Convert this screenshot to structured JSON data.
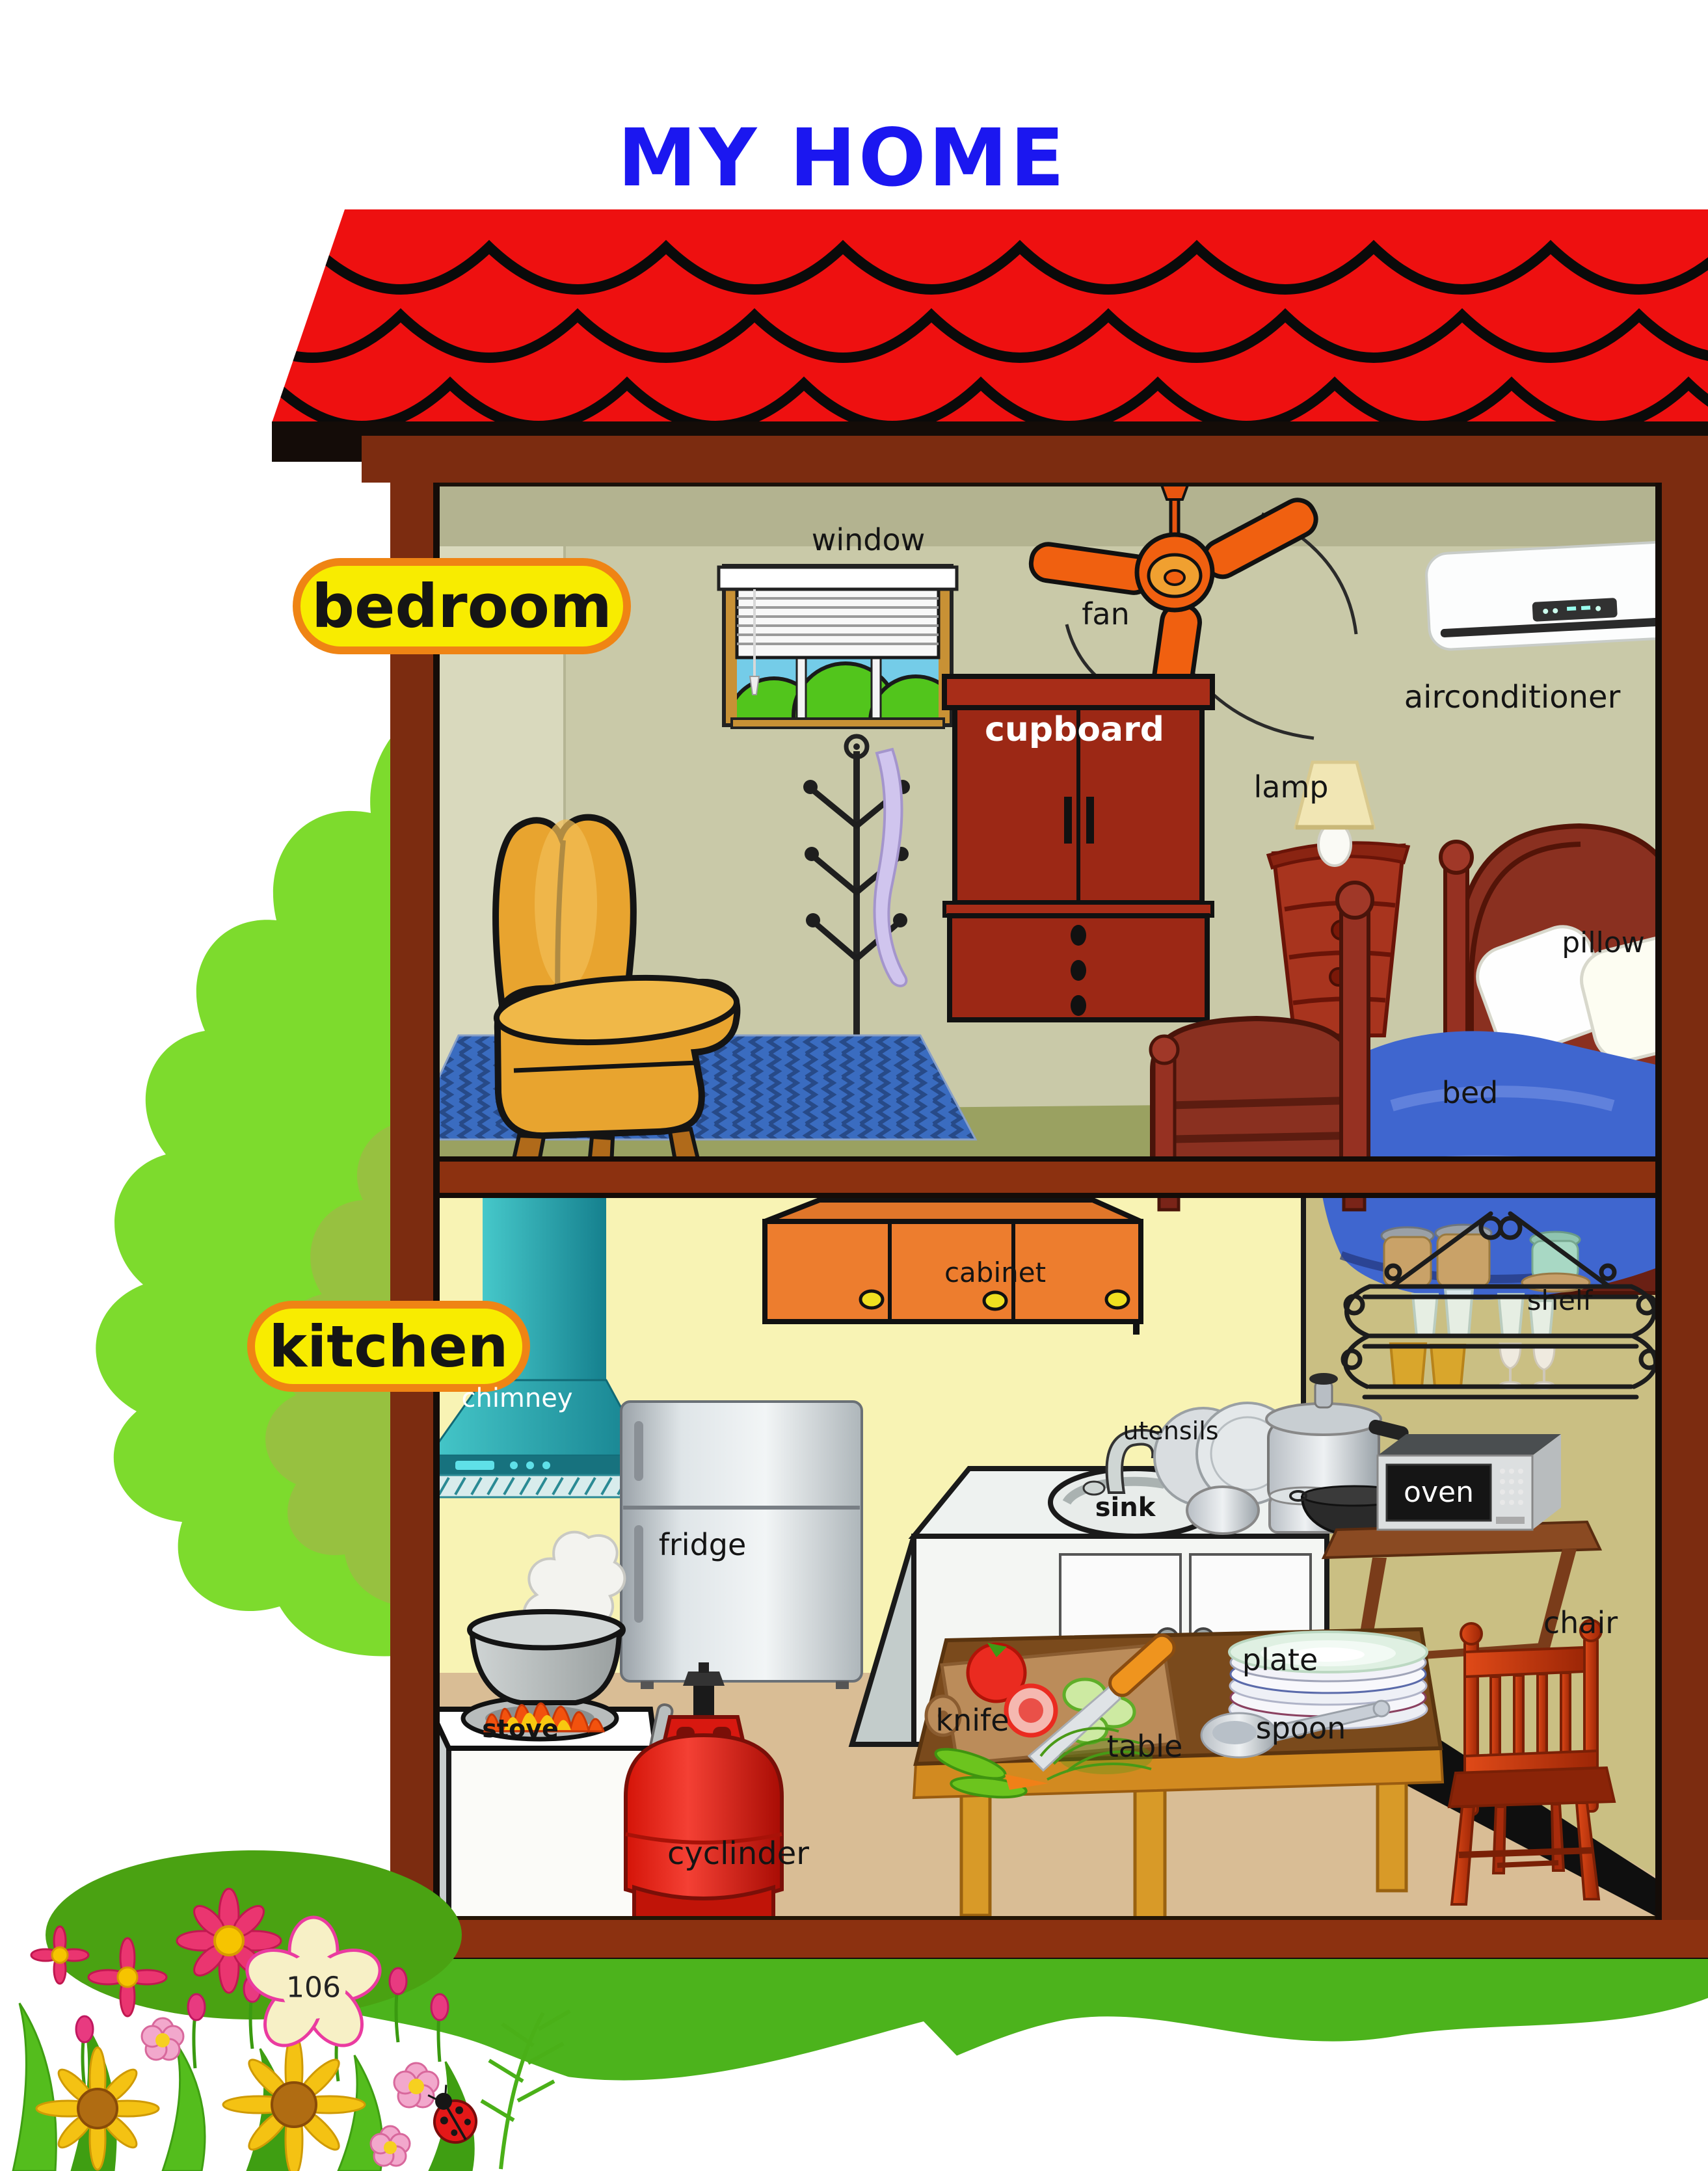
{
  "page": {
    "title": "MY HOME",
    "page_number": "106"
  },
  "sections": {
    "bedroom": {
      "label": "bedroom"
    },
    "kitchen": {
      "label": "kitchen"
    }
  },
  "labels": {
    "window": "window",
    "fan": "fan",
    "airconditioner": "airconditioner",
    "cupboard": "cupboard",
    "lamp": "lamp",
    "pillow": "pillow",
    "bed": "bed",
    "cabinet": "cabinet",
    "shelf": "shelf",
    "chimney": "chimney",
    "utensils": "utensils",
    "oven": "oven",
    "fridge": "fridge",
    "sink": "sink",
    "plate": "plate",
    "chair": "chair",
    "knife": "knife",
    "spoon": "spoon",
    "table": "table",
    "stove": "stove",
    "cylinder": "cyclinder"
  },
  "colors": {
    "title_blue": "#1b17f0",
    "roof_red": "#ee1010",
    "house_brown": "#7c2c10",
    "band_brown": "#8c3110",
    "label_fill": "#f8ec00",
    "label_border": "#ef8414",
    "bedroom_wall": "#c9c9a8",
    "kitchen_wall_left": "#f8f3b4",
    "kitchen_wall_right": "#cabf83",
    "bedroom_floor": "#9aa161",
    "kitchen_floor": "#d9bd95",
    "tree_green": "#7ddb2d",
    "grass_green": "#4cb31c"
  }
}
